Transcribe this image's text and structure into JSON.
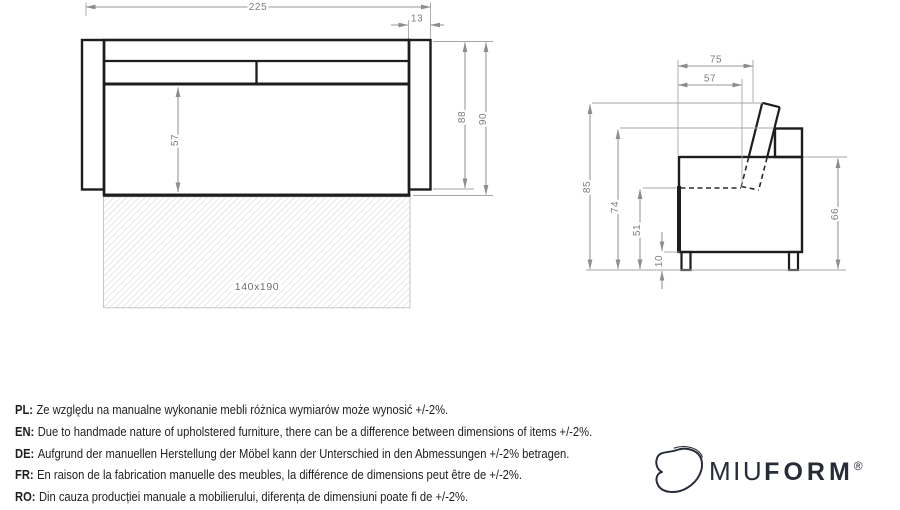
{
  "drawing": {
    "front_view": {
      "dims": {
        "total_width": "225",
        "armrest_width": "13",
        "seat_front_height": "57",
        "body_height": "88",
        "total_height": "90"
      },
      "sleeping_area_label": "140x190"
    },
    "side_view": {
      "dims": {
        "total_depth": "75",
        "seat_depth": "57",
        "total_height": "85",
        "backrest_height": "74",
        "seat_height": "51",
        "leg_height": "10",
        "back_height": "66"
      }
    }
  },
  "notes": [
    {
      "label": "PL:",
      "text": "Ze względu na manualne wykonanie mebli różnica wymiarów może wynosić +/-2%."
    },
    {
      "label": "EN:",
      "text": "Due to handmade nature of upholstered furniture, there can be a difference between dimensions of items +/-2%."
    },
    {
      "label": "DE:",
      "text": "Aufgrund der manuellen Herstellung der Möbel kann der Unterschied in den Abmessungen +/-2% betragen."
    },
    {
      "label": "FR:",
      "text": "En raison de la fabrication manuelle des meubles, la différence de dimensions peut être de +/-2%."
    },
    {
      "label": "RO:",
      "text": "Din cauza producției manuale a mobilierului, diferența de dimensiuni poate fi de +/-2%."
    }
  ],
  "logo": {
    "brand_script": "MIU",
    "brand_bold": "FORM",
    "registered": "®"
  }
}
